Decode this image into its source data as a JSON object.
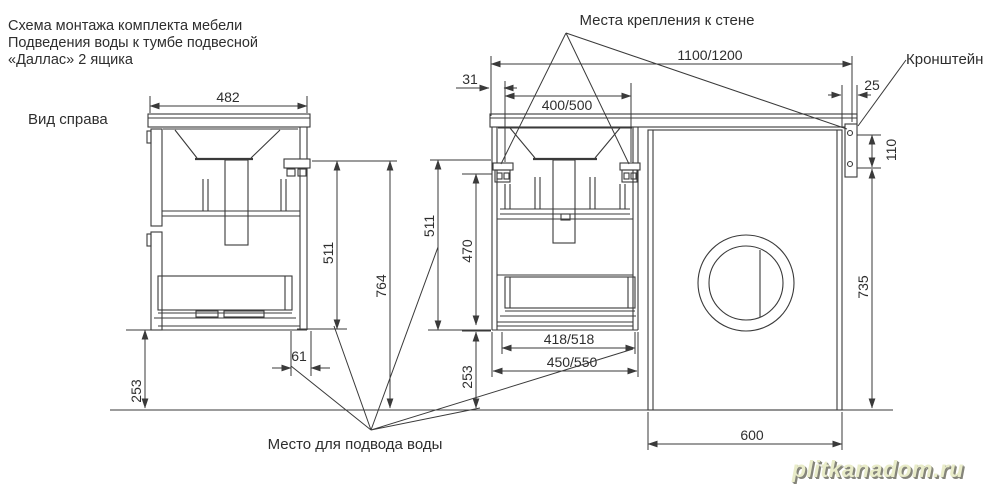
{
  "colors": {
    "line": "#3a3a3a",
    "background": "#ffffff",
    "watermark": "#e9ecc9"
  },
  "title": {
    "line1": "Схема монтажа комплекта мебели",
    "line2": "Подведения воды к тумбе подвесной",
    "line3": "«Даллас» 2 ящика"
  },
  "labels": {
    "side_view": "Вид справа",
    "wall_mount_points": "Места крепления к стене",
    "bracket": "Кронштейн",
    "water_supply": "Место для подвода воды"
  },
  "dims": {
    "depth": "482",
    "height_to_mount_left": "511",
    "mount_to_floor": "764",
    "clearance_left": "253",
    "drain_offset": "61",
    "edge_gap": "31",
    "mount_spacing": "400/500",
    "overall_width": "1100/1200",
    "overhang": "25",
    "bracket_holes": "110",
    "height_to_mount_front": "511",
    "inner_height": "470",
    "clearance_front": "253",
    "inner_width": "418/518",
    "outer_width": "450/550",
    "washer_height": "735",
    "washer_width": "600"
  },
  "watermark": {
    "text": "plitkanadom.ru"
  }
}
